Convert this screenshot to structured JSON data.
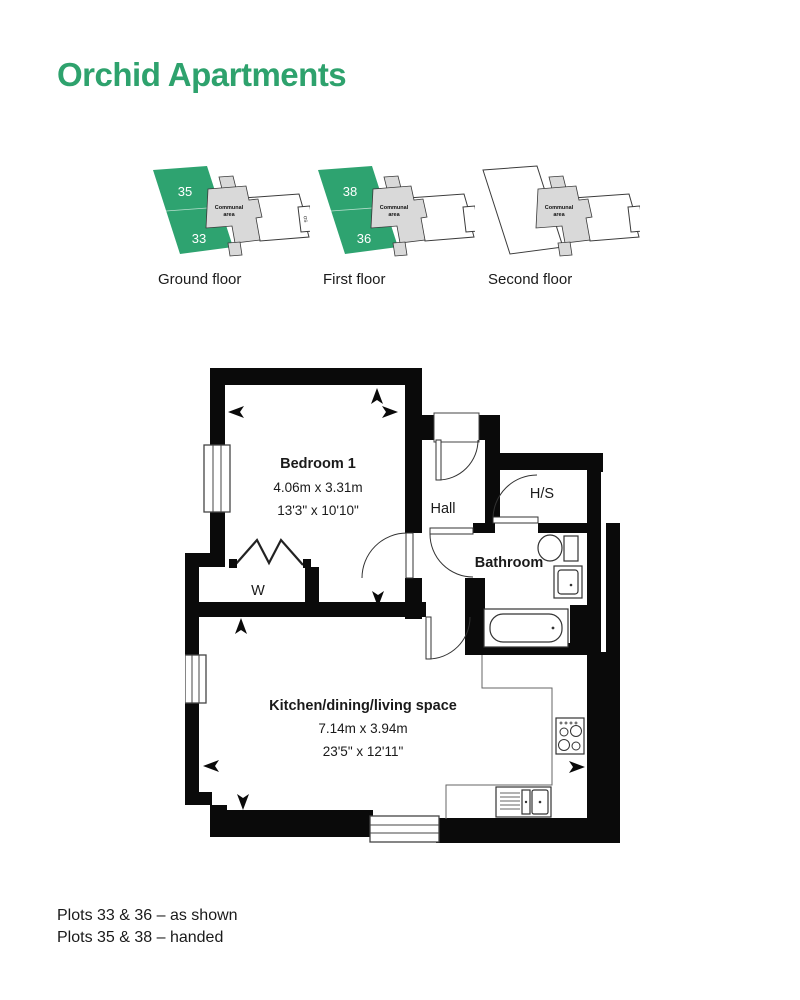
{
  "title": "Orchid Apartments",
  "colors": {
    "accent": "#2EA370",
    "communal_gray": "#d9d9d9",
    "wall": "#0a0a0a"
  },
  "locators": [
    {
      "name": "Ground floor",
      "plots": [
        "35",
        "33"
      ],
      "communal": [
        "Communal",
        "area"
      ],
      "os_label": "OS"
    },
    {
      "name": "First floor",
      "plots": [
        "38",
        "36"
      ],
      "communal": [
        "Communal",
        "area"
      ]
    },
    {
      "name": "Second floor",
      "plots": [],
      "communal": [
        "Communal",
        "area"
      ]
    }
  ],
  "floorplan": {
    "bedroom": {
      "name": "Bedroom 1",
      "metric": "4.06m x 3.31m",
      "imperial": "13'3\" x 10'10\""
    },
    "hall": {
      "name": "Hall"
    },
    "hs": {
      "name": "H/S"
    },
    "bathroom": {
      "name": "Bathroom"
    },
    "wardrobe": {
      "name": "W"
    },
    "kitchen": {
      "name": "Kitchen/dining/living space",
      "metric": "7.14m x 3.94m",
      "imperial": "23'5\" x 12'11\""
    }
  },
  "footer": {
    "line1": "Plots 33 & 36 – as shown",
    "line2": "Plots 35 & 38 – handed"
  }
}
